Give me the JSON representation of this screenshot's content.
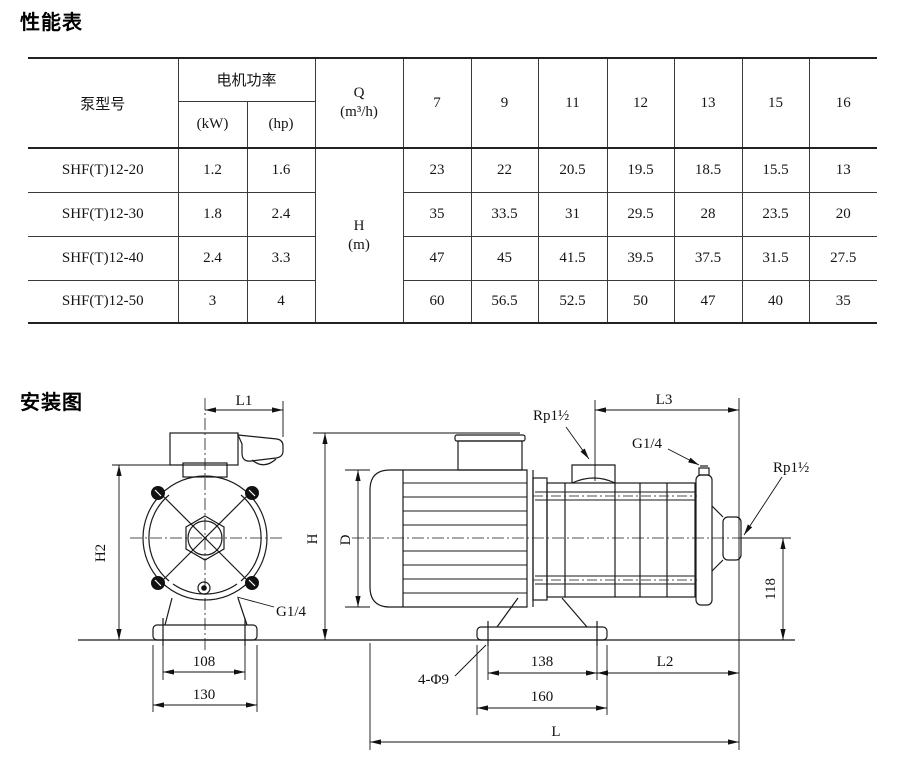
{
  "colors": {
    "background": "#ffffff",
    "ink": "#1a1a1a"
  },
  "performance": {
    "title": "性能表",
    "table": {
      "model_header": "泵型号",
      "power_header": "电机功率",
      "power_unit_kw": "(kW)",
      "power_unit_hp": "(hp)",
      "q_header": "Q",
      "q_unit": "(m³/h)",
      "h_header": "H",
      "h_unit": "(m)",
      "flow_columns": [
        "7",
        "9",
        "11",
        "12",
        "13",
        "15",
        "16"
      ],
      "rows": [
        {
          "model": "SHF(T)12-20",
          "kw": "1.2",
          "hp": "1.6",
          "heads": [
            "23",
            "22",
            "20.5",
            "19.5",
            "18.5",
            "15.5",
            "13"
          ]
        },
        {
          "model": "SHF(T)12-30",
          "kw": "1.8",
          "hp": "2.4",
          "heads": [
            "35",
            "33.5",
            "31",
            "29.5",
            "28",
            "23.5",
            "20"
          ]
        },
        {
          "model": "SHF(T)12-40",
          "kw": "2.4",
          "hp": "3.3",
          "heads": [
            "47",
            "45",
            "41.5",
            "39.5",
            "37.5",
            "31.5",
            "27.5"
          ]
        },
        {
          "model": "SHF(T)12-50",
          "kw": "3",
          "hp": "4",
          "heads": [
            "60",
            "56.5",
            "52.5",
            "50",
            "47",
            "40",
            "35"
          ]
        }
      ]
    }
  },
  "installation": {
    "title": "安装图",
    "front": {
      "l1": "L1",
      "h2": "H2",
      "dim108": "108",
      "dim130": "130",
      "g14": "G1/4"
    },
    "side": {
      "rp_suction": "Rp1½",
      "g14_vent": "G1/4",
      "rp_discharge": "Rp1½",
      "l3": "L3",
      "h": "H",
      "d": "D",
      "dim118": "118",
      "holes": "4-Φ9",
      "dim138": "138",
      "dim160": "160",
      "l2": "L2",
      "l": "L"
    }
  }
}
